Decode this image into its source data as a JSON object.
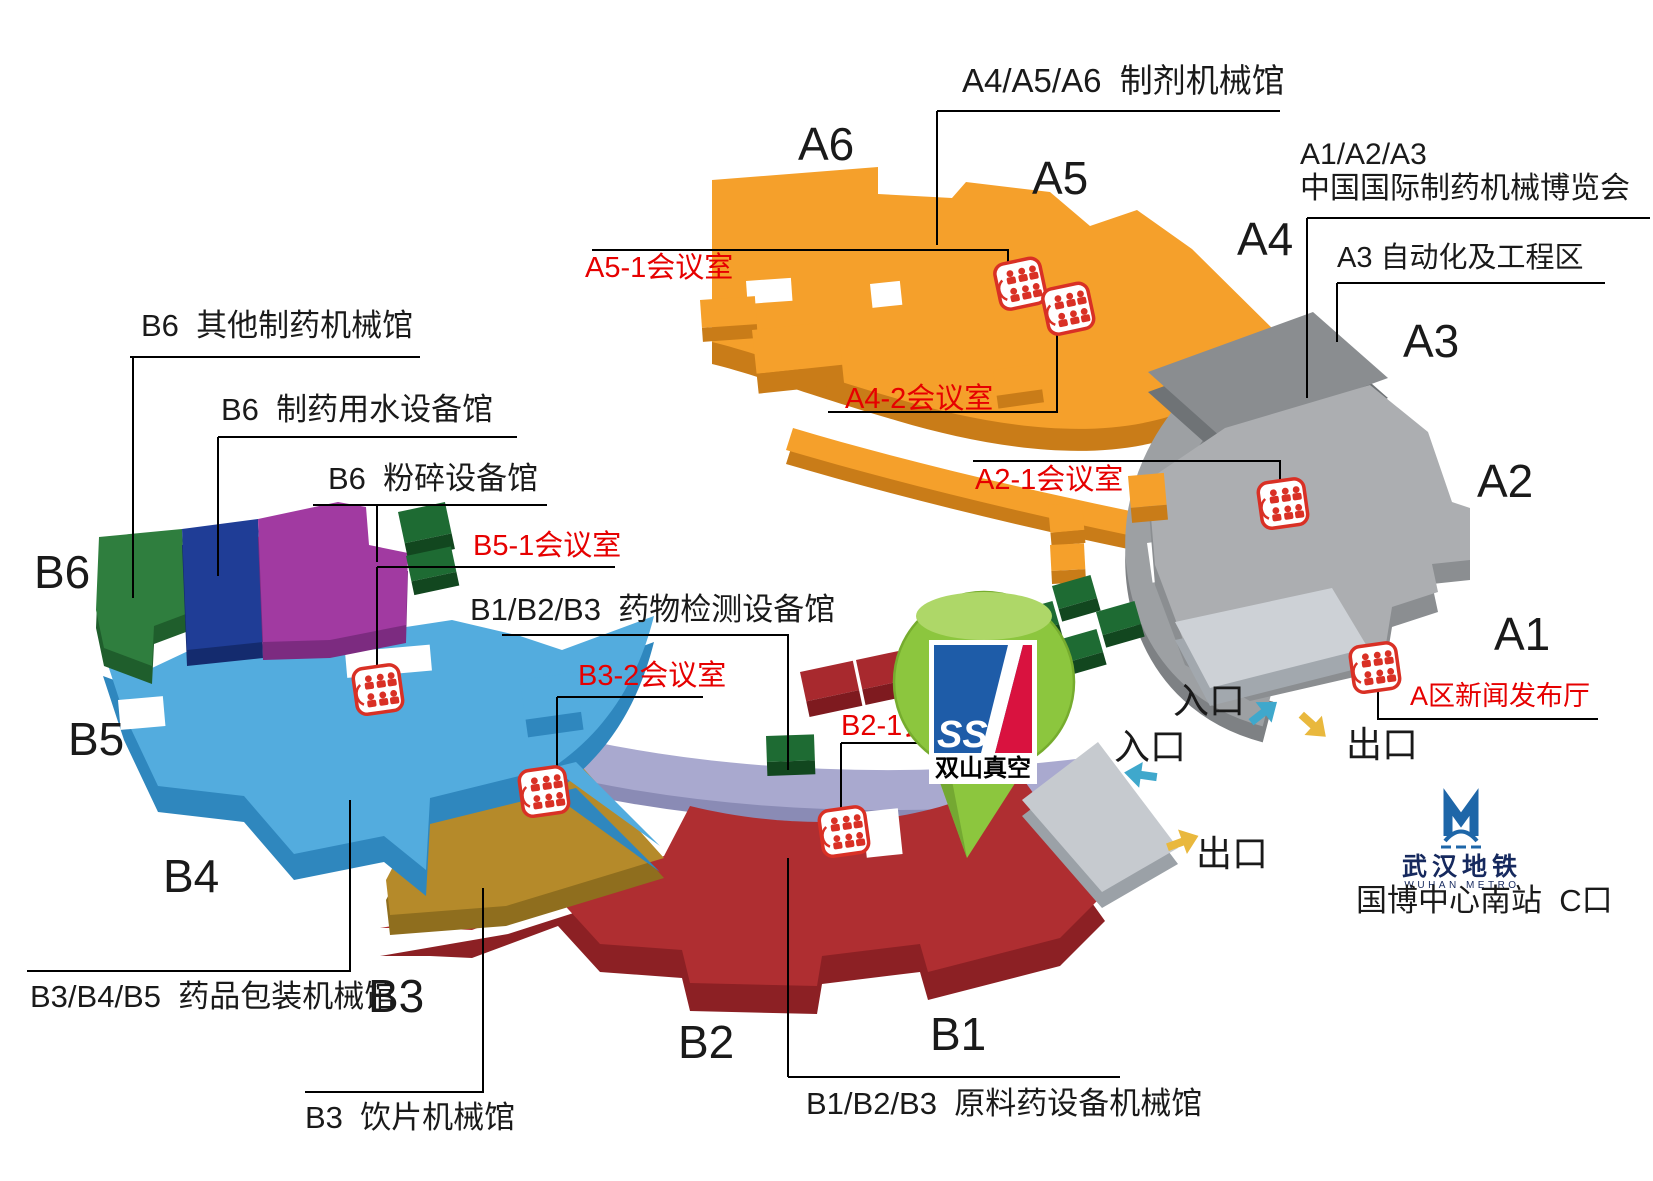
{
  "colors": {
    "hall_a456_orange": "#F5A02B",
    "hall_a456_orange_side": "#C97C18",
    "hall_a123_gray": "#ACAEB1",
    "hall_a3_gray": "#8A8D90",
    "walkway_gray": "#9DA0A3",
    "hall_a1_platform": "#CDD1D6",
    "hall_b6_green": "#2F7E3E",
    "hall_b6_blue": "#1F3D96",
    "hall_b6_purple": "#A13AA1",
    "hall_b45_blue": "#53ACDE",
    "hall_b3_gold": "#B58A2A",
    "hall_b123_red": "#AF2E31",
    "walkway_lavender": "#A9A9CF",
    "meeting_icon_red": "#D93025",
    "label_red": "#E60000",
    "label_black": "#1A1A1A",
    "arrow_blue": "#3FA8CC",
    "arrow_yellow": "#E9B83D",
    "pin_green": "#8CC63E",
    "logo_blue": "#1E5CA8",
    "logo_red": "#D9123F",
    "metro_blue": "#1E66A8"
  },
  "zones": {
    "a456_title": "A4/A5/A6  制剂机械馆",
    "a123_title_line1": "A1/A2/A3",
    "a123_title_line2": "中国国际制药机械博览会",
    "a3_area_label": "A3 自动化及工程区",
    "b6_other_label": "B6  其他制药机械馆",
    "b6_water_label": "B6  制药用水设备馆",
    "b6_crush_label": "B6  粉碎设备馆",
    "b123_test_label": "B1/B2/B3  药物检测设备馆",
    "b345_pack_label": "B3/B4/B5  药品包装机械馆",
    "b3_slice_label": "B3  饮片机械馆",
    "b123_material_label": "B1/B2/B3  原料药设备机械馆"
  },
  "halls": {
    "a6": "A6",
    "a5": "A5",
    "a4": "A4",
    "a3": "A3",
    "a2": "A2",
    "a1": "A1",
    "b6": "B6",
    "b5": "B5",
    "b4": "B4",
    "b3": "B3",
    "b2": "B2",
    "b1": "B1"
  },
  "meeting_rooms": {
    "a5_1": "A5-1会议室",
    "a4_2": "A4-2会议室",
    "a2_1": "A2-1会议室",
    "b5_1": "B5-1会议室",
    "b3_2": "B3-2会议室",
    "b2_1": "B2-1会议室",
    "a_news": "A区新闻发布厅"
  },
  "navigation": {
    "entrance": "入口",
    "exit": "出口",
    "metro_name_cn": "武汉地铁",
    "metro_name_en": "WUHAN METRO",
    "station": "国博中心南站  C口"
  },
  "pin": {
    "logo_text": "SSI",
    "logo_name": "双山真空"
  }
}
